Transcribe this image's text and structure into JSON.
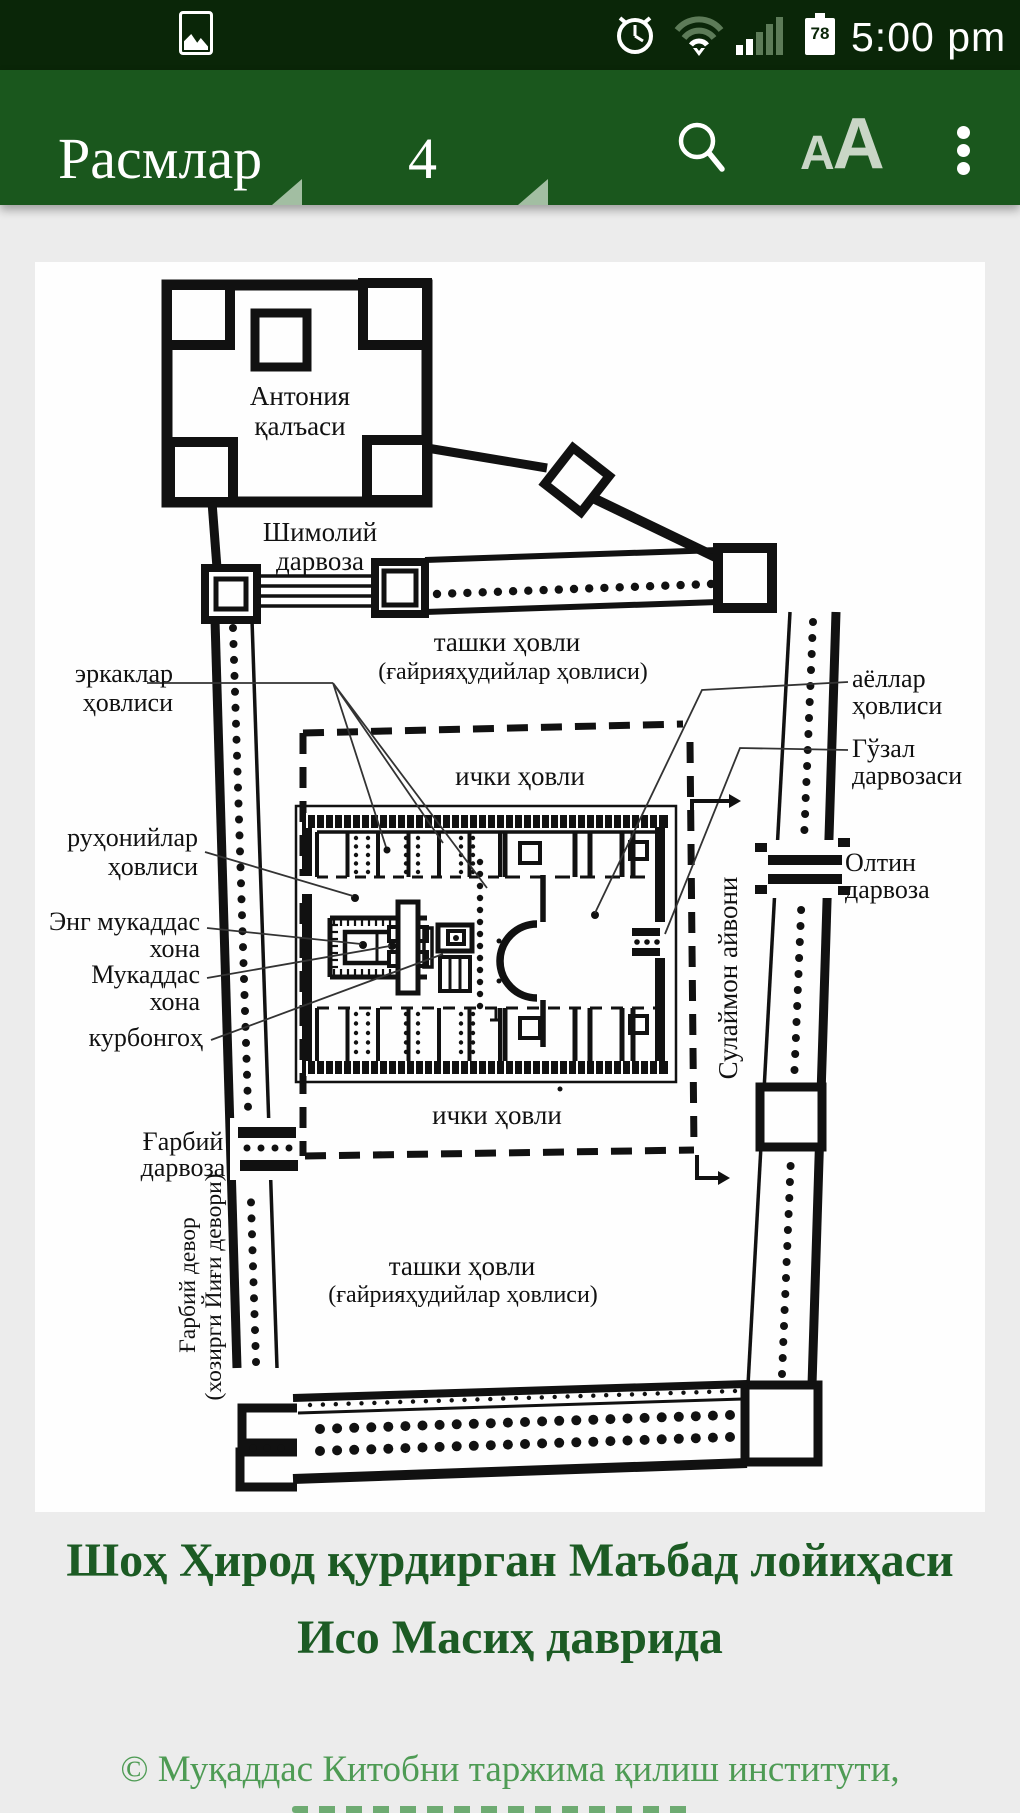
{
  "status_bar": {
    "time": "5:00 pm",
    "battery_percent": "78",
    "icons": [
      "image-notification-icon",
      "alarm-icon",
      "wifi-icon",
      "signal-icon",
      "battery-icon"
    ]
  },
  "app_bar": {
    "title": "Расмлар",
    "page_number": "4",
    "font_icon_small": "A",
    "font_icon_large": "A",
    "icons": [
      "search-icon",
      "font-size-icon",
      "overflow-menu-icon"
    ],
    "accent_color": "#1a571d"
  },
  "diagram": {
    "labels": {
      "antonia_1": "Антония",
      "antonia_2": "қалъаси",
      "shimoliy_1": "Шимолий",
      "shimoliy_2": "дарвоза",
      "tashqi_top_1": "ташки ҳовли",
      "tashqi_top_2": "(ғайрияҳудийлар ҳовлиси)",
      "erkaklar_1": "эркаклар",
      "erkaklar_2": "ҳовлиси",
      "ayollar_1": "аёллар",
      "ayollar_2": "ҳовлиси",
      "guzal_1": "Гўзал",
      "guzal_2": "дарвозаси",
      "ichki_top": "ички ҳовли",
      "ruhoniylar_1": "руҳонийлар",
      "ruhoniylar_2": "ҳовлиси",
      "oltin_1": "Олтин",
      "oltin_2": "дарвоза",
      "eng_muqaddas_1": "Энг мукаддас",
      "eng_muqaddas_2": "хона",
      "muqaddas_1": "Мукаддас",
      "muqaddas_2": "хона",
      "qurbongoh": "курбонгоҳ",
      "sulaymon": "Сулаймон айвони",
      "gharbiy_darvoza_1": "Ғарбий",
      "gharbiy_darvoza_2": "дарвоза",
      "ichki_bottom": "ички ҳовли",
      "gharbiy_devor_1": "Ғарбий девор",
      "gharbiy_devor_2": "(хозирги Йиғи девори)",
      "tashqi_bottom_1": "ташки ҳовли",
      "tashqi_bottom_2": "(ғайрияҳудийлар ҳовлиси)"
    }
  },
  "caption": {
    "line1": "Шоҳ Ҳирод қурдирган Маъбад лойиҳаси",
    "line2": "Исо Масиҳ даврида"
  },
  "footer": {
    "line1": "© Муқаддас Китобни таржима қилиш институти,"
  }
}
